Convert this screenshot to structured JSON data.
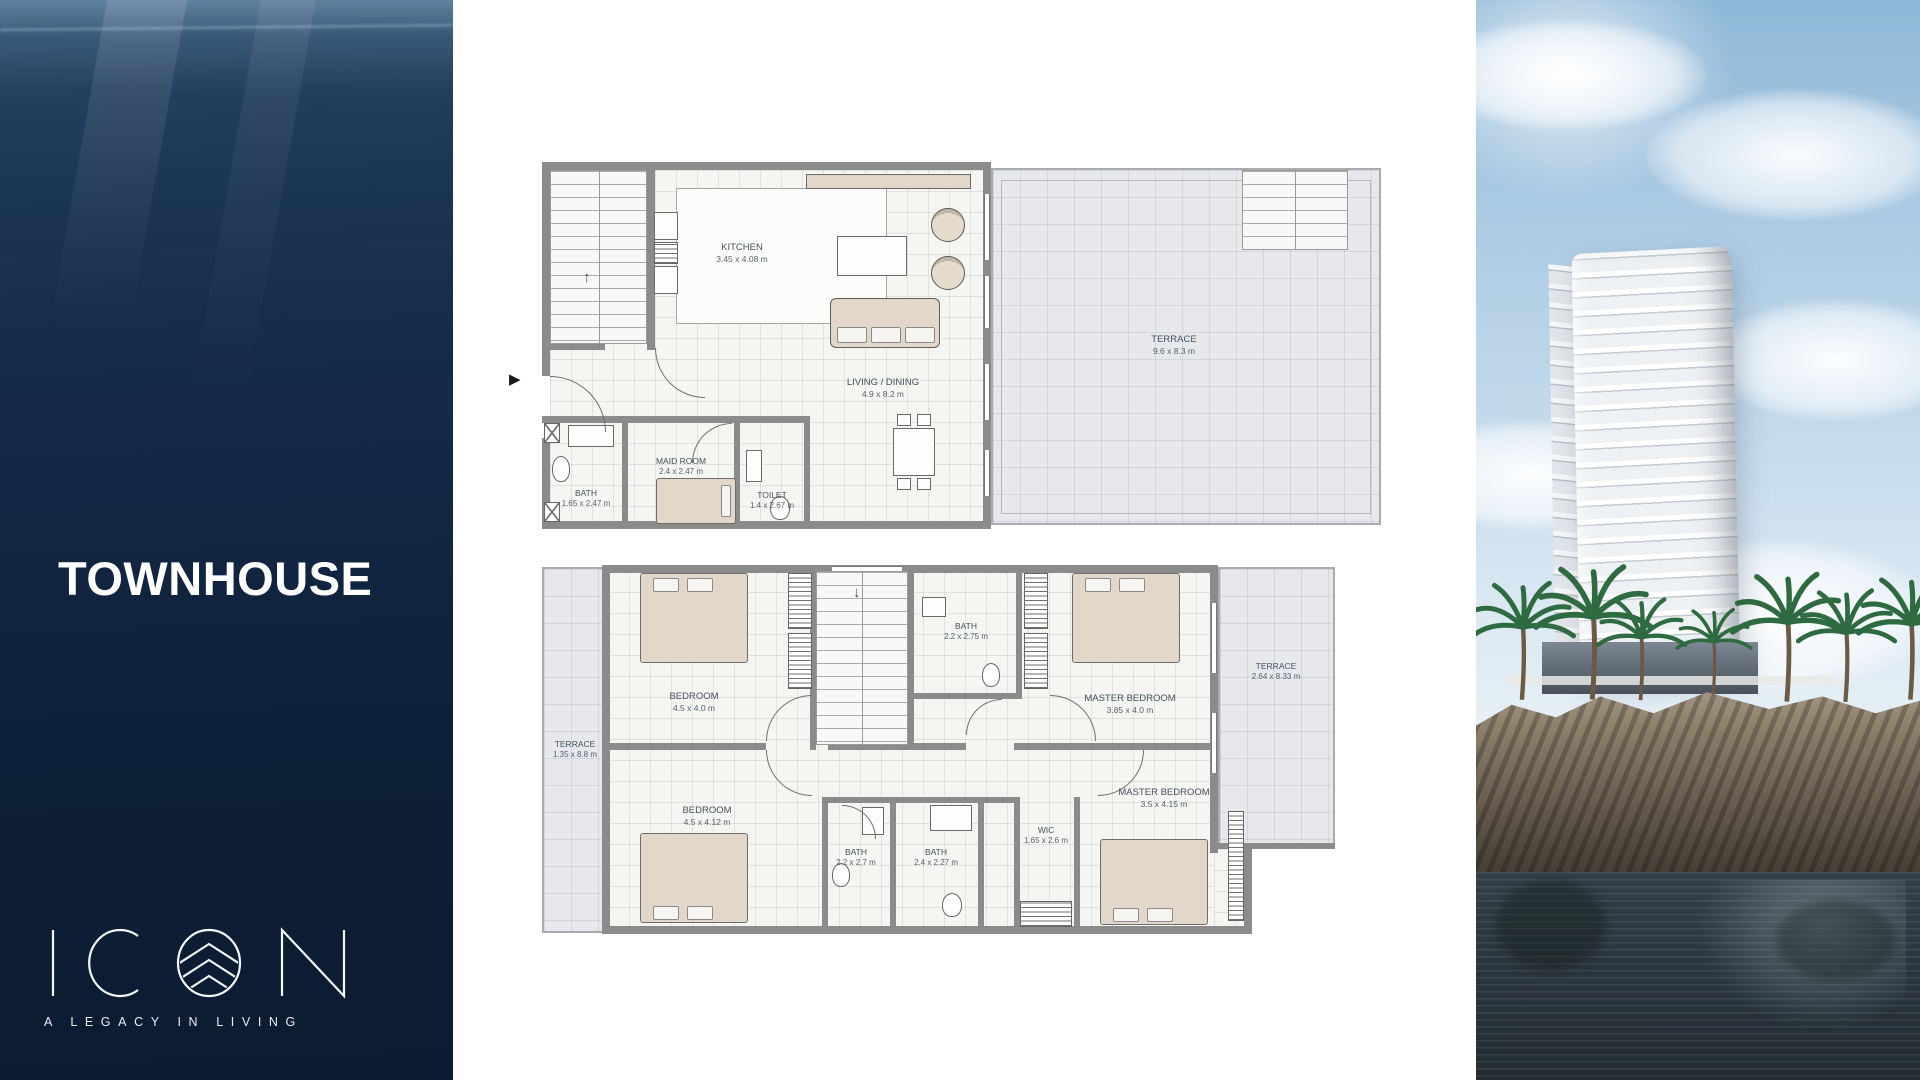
{
  "brand": {
    "title": "TOWNHOUSE",
    "logo_text": "ICON",
    "tagline": "A LEGACY IN LIVING"
  },
  "icons": {
    "plan_pointer": "▶",
    "stairs_up_arrow": "↑",
    "stairs_down_arrow": "↓"
  },
  "colors": {
    "ocean_top": "#33516f",
    "ocean_bottom": "#0b1b31",
    "title_text": "#ffffff",
    "plan_wall": "#8b8b8b",
    "plan_floor": "#f5f5f2",
    "terrace_fill": "#e7e8eb",
    "label_text": "#44525f",
    "furniture_tan": "#e2d7c8"
  },
  "ground_floor": {
    "kitchen": {
      "name": "KITCHEN",
      "dims": "3.45 x 4.08 m"
    },
    "living_dining": {
      "name": "LIVING / DINING",
      "dims": "4.9 x 8.2 m"
    },
    "maid_room": {
      "name": "MAID ROOM",
      "dims": "2.4 x 2.47 m"
    },
    "bath": {
      "name": "BATH",
      "dims": "1.65 x 2.47 m"
    },
    "toilet": {
      "name": "TOILET",
      "dims": "1.4 x 2.67 m"
    },
    "terrace": {
      "name": "TERRACE",
      "dims": "9.6 x 8.3 m"
    }
  },
  "first_floor": {
    "bedroom_1": {
      "name": "BEDROOM",
      "dims": "4.5 x 4.0 m"
    },
    "bath_top": {
      "name": "BATH",
      "dims": "2.2 x 2.75 m"
    },
    "master_bedroom_1": {
      "name": "MASTER BEDROOM",
      "dims": "3.85 x 4.0 m"
    },
    "terrace_right": {
      "name": "TERRACE",
      "dims": "2.64 x 8.33 m"
    },
    "terrace_left": {
      "name": "TERRACE",
      "dims": "1.35 x 8.8 m"
    },
    "bedroom_2": {
      "name": "BEDROOM",
      "dims": "4.5 x 4.12 m"
    },
    "bath_left": {
      "name": "BATH",
      "dims": "2.2 x 2.7 m"
    },
    "bath_mid": {
      "name": "BATH",
      "dims": "2.4 x 2.27 m"
    },
    "wic": {
      "name": "WIC",
      "dims": "1.65 x 2.6 m"
    },
    "master_bedroom_2": {
      "name": "MASTER BEDROOM",
      "dims": "3.5 x 4.15 m"
    }
  }
}
